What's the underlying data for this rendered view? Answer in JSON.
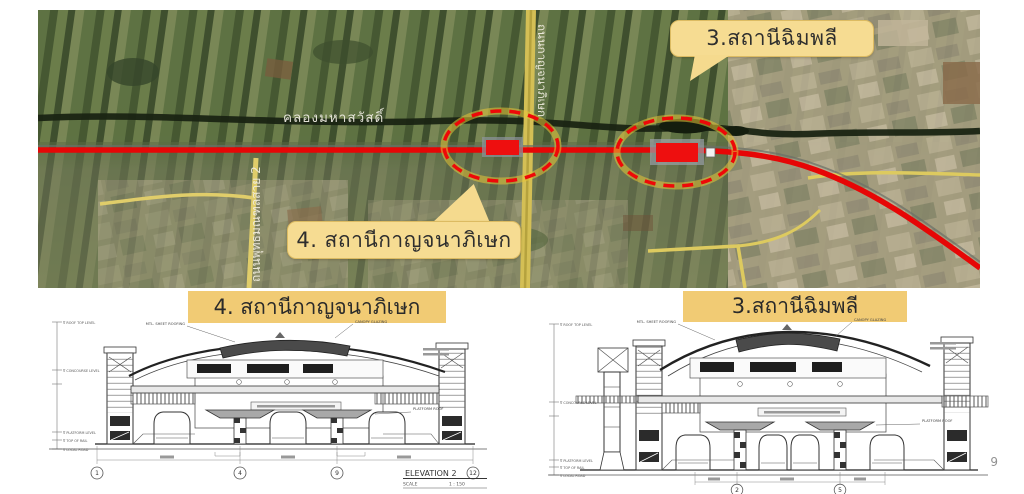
{
  "page": {
    "number": "9"
  },
  "colors": {
    "route_red": "#e60606",
    "marker_red": "#ee0f0f",
    "ellipse_glow": "#e6c438",
    "callout_bg": "#f6dc92",
    "title_highlight": "#f1cb74",
    "road_yellow": "#d4bf55",
    "canal_dark": "#1a2413"
  },
  "map": {
    "canal_label": "คลองมหาสวัสดิ์",
    "road_left_label": "ถนนพุทธมณฑลสาย 2",
    "road_center_label": "ถนนกาญจนาภิเษก",
    "callout_chimphli": "3.สถานีฉิมพลี",
    "callout_kanchanaphisek": "4. สถานีกาญจนาภิเษก"
  },
  "drawings": {
    "left": {
      "title": "4. สถานีกาญจนาภิเษก",
      "caption_title": "ELEVATION  2",
      "caption_scale_label": "SCALE",
      "caption_scale_value": "1 : 150",
      "grid": [
        "1",
        "4",
        "9",
        "12"
      ],
      "levels": [
        "∇ ROOF TOP LEVEL",
        "∇ CONCOURSE LEVEL",
        "∇ PLATFORM LEVEL",
        "∇ TOP OF RAIL",
        "∇ LOCAL ROAD"
      ],
      "annotations": {
        "roof": "MTL. SHEET ROOFING",
        "canopy": "CANOPY GLAZING",
        "platform_roof": "PLATFORM ROOF"
      }
    },
    "right": {
      "title": "3.สถานีฉิมพลี",
      "grid": [
        "2",
        "5"
      ],
      "levels": [
        "∇ ROOF TOP LEVEL",
        "∇ CONCOURSE LEVEL",
        "∇ PLATFORM LEVEL",
        "∇ TOP OF RAIL",
        "∇ LOCAL ROAD"
      ],
      "annotations": {
        "roof": "MTL. SHEET ROOFING",
        "canopy": "CANOPY GLAZING",
        "platform_roof": "PLATFORM ROOF"
      }
    }
  }
}
